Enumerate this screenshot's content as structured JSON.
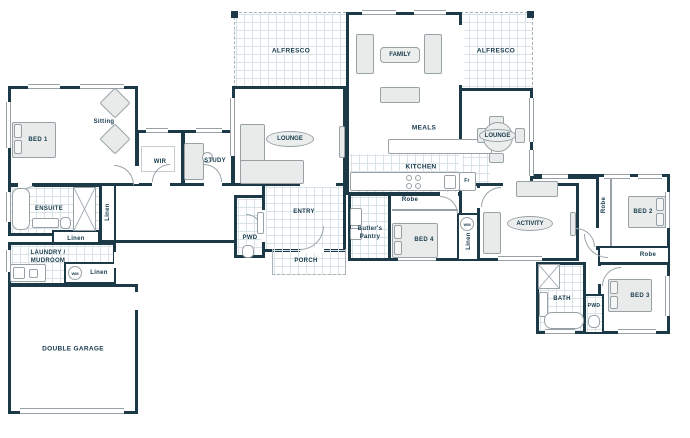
{
  "colors": {
    "wall": "#1c3947",
    "text": "#16394b",
    "tile_line": "#d9e2e7",
    "furniture_stroke": "#98a1a6"
  },
  "labels": {
    "bed1": "BED 1",
    "sitting": "Sitting",
    "wir": "WIR",
    "study": "STUDY",
    "ensuite": "ENSUITE",
    "linen": "Linen",
    "laundry_line1": "LAUNDRY /",
    "laundry_line2": "MUDROOM",
    "wm": "WM",
    "garage": "DOUBLE GARAGE",
    "alfresco": "ALFRESCO",
    "family": "FAMILY",
    "lounge": "LOUNGE",
    "meals": "MEALS",
    "kitchen": "KITCHEN",
    "fridge": "Fr",
    "entry": "ENTRY",
    "porch": "PORCH",
    "pwd": "PWD",
    "butlers_line1": "Butler's",
    "butlers_line2": "Pantry",
    "robe": "Robe",
    "bed4": "BED 4",
    "activity": "ACTIVITY",
    "bed2": "BED 2",
    "bed3": "BED 3",
    "bath": "BATH"
  }
}
